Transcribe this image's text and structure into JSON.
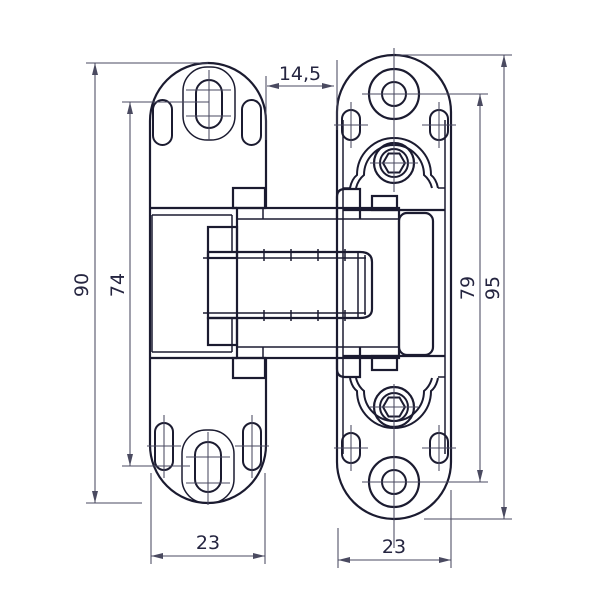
{
  "drawing": {
    "type": "technical_drawing",
    "subject": "concealed hinge front view with two mounting plates",
    "dimension_labels": {
      "gap_between_plates": "14,5",
      "left_plate_height": "90",
      "left_plate_hole_spacing": "74",
      "right_plate_hole_spacing": "79",
      "right_plate_height": "95",
      "left_plate_width": "23",
      "right_plate_width": "23"
    },
    "colors": {
      "background": "#ffffff",
      "outline": "#1b1b30",
      "dimension_lines": "#4a4a60",
      "label_text": "#252540"
    }
  }
}
